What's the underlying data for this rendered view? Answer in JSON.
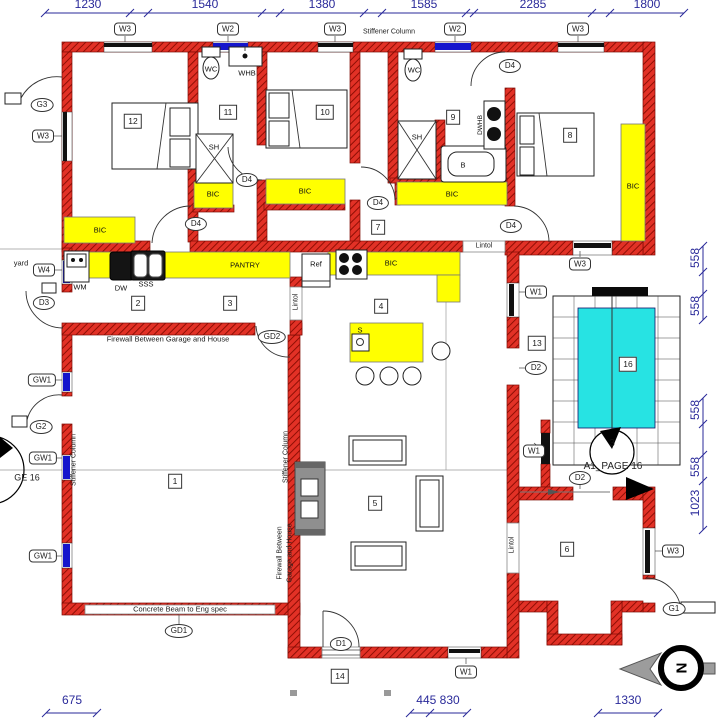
{
  "colors": {
    "wall": "#e23126",
    "wall_dark": "#8f0f05",
    "win_blue": "#1515cc",
    "bic_yellow": "#ffff00",
    "pool_cyan": "#27e3e3",
    "dim_blue": "#2a2a9a"
  },
  "compass": {
    "letter": "N"
  },
  "hex_labels": [
    {
      "t": "W3",
      "x": 125,
      "y": 29
    },
    {
      "t": "W2",
      "x": 228,
      "y": 29
    },
    {
      "t": "W3",
      "x": 335,
      "y": 29
    },
    {
      "t": "W2",
      "x": 455,
      "y": 29
    },
    {
      "t": "W3",
      "x": 578,
      "y": 29
    },
    {
      "t": "W3",
      "x": 43,
      "y": 136
    },
    {
      "t": "W4",
      "x": 44,
      "y": 270
    },
    {
      "t": "GW1",
      "x": 42,
      "y": 380
    },
    {
      "t": "GW1",
      "x": 43,
      "y": 458
    },
    {
      "t": "GW1",
      "x": 43,
      "y": 556
    },
    {
      "t": "W3",
      "x": 580,
      "y": 264
    },
    {
      "t": "W1",
      "x": 536,
      "y": 292
    },
    {
      "t": "W1",
      "x": 534,
      "y": 451
    },
    {
      "t": "W3",
      "x": 673,
      "y": 551
    },
    {
      "t": "W1",
      "x": 466,
      "y": 672
    }
  ],
  "oval_labels": [
    {
      "t": "G3",
      "x": 42,
      "y": 105
    },
    {
      "t": "D3",
      "x": 44,
      "y": 303
    },
    {
      "t": "G2",
      "x": 41,
      "y": 427
    },
    {
      "t": "D4",
      "x": 196,
      "y": 224
    },
    {
      "t": "D4",
      "x": 247,
      "y": 180
    },
    {
      "t": "D4",
      "x": 378,
      "y": 203
    },
    {
      "t": "D4",
      "x": 510,
      "y": 66
    },
    {
      "t": "D4",
      "x": 511,
      "y": 226
    },
    {
      "t": "GD2",
      "x": 272,
      "y": 337
    },
    {
      "t": "GD1",
      "x": 179,
      "y": 631
    },
    {
      "t": "D2",
      "x": 536,
      "y": 368
    },
    {
      "t": "D2",
      "x": 580,
      "y": 478
    },
    {
      "t": "D1",
      "x": 341,
      "y": 644
    },
    {
      "t": "G1",
      "x": 674,
      "y": 609
    }
  ],
  "room_numbers": [
    {
      "t": "12",
      "x": 133,
      "y": 121
    },
    {
      "t": "11",
      "x": 228,
      "y": 112
    },
    {
      "t": "10",
      "x": 325,
      "y": 112
    },
    {
      "t": "9",
      "x": 453,
      "y": 117
    },
    {
      "t": "8",
      "x": 570,
      "y": 135
    },
    {
      "t": "7",
      "x": 378,
      "y": 227
    },
    {
      "t": "2",
      "x": 138,
      "y": 303
    },
    {
      "t": "3",
      "x": 230,
      "y": 303
    },
    {
      "t": "4",
      "x": 381,
      "y": 306
    },
    {
      "t": "13",
      "x": 537,
      "y": 343
    },
    {
      "t": "16",
      "x": 628,
      "y": 364
    },
    {
      "t": "1",
      "x": 175,
      "y": 481
    },
    {
      "t": "5",
      "x": 375,
      "y": 503
    },
    {
      "t": "6",
      "x": 567,
      "y": 549
    },
    {
      "t": "14",
      "x": 340,
      "y": 676
    }
  ],
  "fixtures": [
    {
      "t": "WC",
      "x": 211,
      "y": 69
    },
    {
      "t": "WHB",
      "x": 247,
      "y": 73
    },
    {
      "t": "WC",
      "x": 414,
      "y": 70
    },
    {
      "t": "SH",
      "x": 214,
      "y": 147
    },
    {
      "t": "SH",
      "x": 417,
      "y": 137
    },
    {
      "t": "B",
      "x": 463,
      "y": 165
    },
    {
      "t": "DWHB",
      "x": 481,
      "y": 125,
      "rot": -90,
      "fs": 6.5
    },
    {
      "t": "WM",
      "x": 80,
      "y": 287
    },
    {
      "t": "DW",
      "x": 121,
      "y": 288
    },
    {
      "t": "SSS",
      "x": 146,
      "y": 284
    },
    {
      "t": "Ref",
      "x": 316,
      "y": 264
    },
    {
      "t": "PANTRY",
      "x": 245,
      "y": 265
    },
    {
      "t": "S",
      "x": 360,
      "y": 330
    },
    {
      "t": "BIC",
      "x": 100,
      "y": 230
    },
    {
      "t": "BIC",
      "x": 213,
      "y": 194
    },
    {
      "t": "BIC",
      "x": 305,
      "y": 191
    },
    {
      "t": "BIC",
      "x": 452,
      "y": 194
    },
    {
      "t": "BIC",
      "x": 633,
      "y": 186
    },
    {
      "t": "BIC",
      "x": 391,
      "y": 263
    },
    {
      "t": "3",
      "x": 612,
      "y": 444,
      "fs": 10
    }
  ],
  "annotations": [
    {
      "t": "Stiffener Column",
      "x": 389,
      "y": 32
    },
    {
      "t": "Stiffener Column",
      "x": 74,
      "y": 460,
      "rot": -90
    },
    {
      "t": "Stiffener Column",
      "x": 286,
      "y": 457,
      "rot": -90
    },
    {
      "t": "Firewall Between Garage and House",
      "x": 168,
      "y": 339,
      "fs": 7.5
    },
    {
      "t": "Firewall Between",
      "x": 280,
      "y": 553,
      "rot": -90
    },
    {
      "t": "Garage and House",
      "x": 290,
      "y": 553,
      "rot": -90
    },
    {
      "t": "Concrete Beam to Eng spec",
      "x": 180,
      "y": 609,
      "fs": 7.5
    },
    {
      "t": "Lintol",
      "x": 484,
      "y": 246
    },
    {
      "t": "Lintol",
      "x": 296,
      "y": 302,
      "rot": -90
    },
    {
      "t": "Lintol",
      "x": 512,
      "y": 545,
      "rot": -90
    },
    {
      "t": "yard",
      "x": 21,
      "y": 263,
      "fs": 7.5
    },
    {
      "t": "GE 16",
      "x": 27,
      "y": 478,
      "fs": 9
    },
    {
      "t": "A1_PAGE 16",
      "x": 613,
      "y": 467,
      "fs": 10
    }
  ],
  "dims_top": [
    {
      "t": "1230",
      "x": 88,
      "y": 4
    },
    {
      "t": "1540",
      "x": 205,
      "y": 4
    },
    {
      "t": "1380",
      "x": 322,
      "y": 4
    },
    {
      "t": "1585",
      "x": 424,
      "y": 4
    },
    {
      "t": "2285",
      "x": 533,
      "y": 4
    },
    {
      "t": "1800",
      "x": 647,
      "y": 4
    }
  ],
  "dims_right": [
    {
      "t": "558",
      "x": 695,
      "y": 258,
      "rot": -90
    },
    {
      "t": "558",
      "x": 695,
      "y": 306,
      "rot": -90
    },
    {
      "t": "558",
      "x": 695,
      "y": 410,
      "rot": -90
    },
    {
      "t": "558",
      "x": 695,
      "y": 467,
      "rot": -90
    },
    {
      "t": "1023",
      "x": 695,
      "y": 503,
      "rot": -90
    }
  ],
  "dims_bottom": [
    {
      "t": "675",
      "x": 72,
      "y": 700
    },
    {
      "t": "445 830",
      "x": 438,
      "y": 700
    },
    {
      "t": "1330",
      "x": 628,
      "y": 700
    }
  ]
}
